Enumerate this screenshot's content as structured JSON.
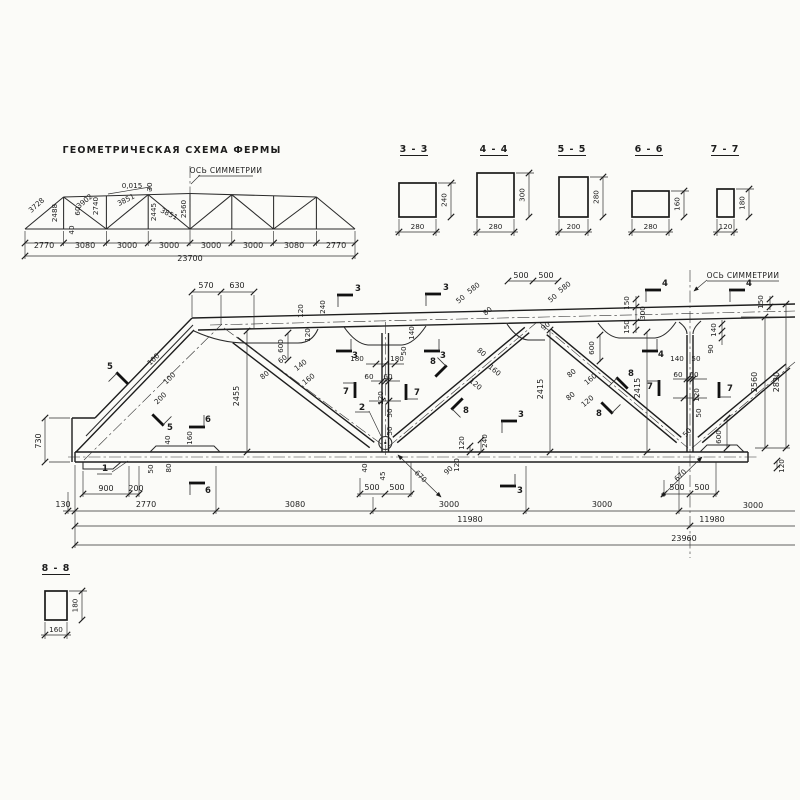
{
  "scheme": {
    "title": "ГЕОМЕТРИЧЕСКАЯ СХЕМА ФЕРМЫ",
    "axis_label": "ОСЬ СИММЕТРИИ",
    "labels": [
      {
        "t": "3728",
        "x": 38,
        "y": 207,
        "r": -42
      },
      {
        "t": "2488",
        "x": 57,
        "y": 213,
        "r": -90
      },
      {
        "t": "3902",
        "x": 86,
        "y": 203,
        "r": -40
      },
      {
        "t": "2740",
        "x": 98,
        "y": 206,
        "r": -90
      },
      {
        "t": "60",
        "x": 80,
        "y": 211,
        "r": -90
      },
      {
        "t": "40",
        "x": 74,
        "y": 230,
        "r": -90
      },
      {
        "t": "0,015",
        "x": 132,
        "y": 188
      },
      {
        "t": "30",
        "x": 152,
        "y": 187,
        "r": -90
      },
      {
        "t": "3851",
        "x": 127,
        "y": 202,
        "r": -27
      },
      {
        "t": "2445",
        "x": 156,
        "y": 212,
        "r": -90
      },
      {
        "t": "3851",
        "x": 168,
        "y": 216,
        "r": 27
      },
      {
        "t": "2560",
        "x": 186,
        "y": 209,
        "r": -90
      },
      {
        "t": "2770",
        "x": 44,
        "y": 248,
        "c": "b"
      },
      {
        "t": "3080",
        "x": 85,
        "y": 248,
        "c": "b"
      },
      {
        "t": "3000",
        "x": 127,
        "y": 248,
        "c": "b"
      },
      {
        "t": "3000",
        "x": 169,
        "y": 248,
        "c": "b"
      },
      {
        "t": "3000",
        "x": 211,
        "y": 248,
        "c": "b"
      },
      {
        "t": "3000",
        "x": 253,
        "y": 248,
        "c": "b"
      },
      {
        "t": "3080",
        "x": 294,
        "y": 248,
        "c": "b"
      },
      {
        "t": "2770",
        "x": 336,
        "y": 248,
        "c": "b"
      },
      {
        "t": "23700",
        "x": 190,
        "y": 261,
        "c": "b"
      }
    ]
  },
  "sections": {
    "items": [
      {
        "name": "3 - 3",
        "width": "280",
        "height": "240",
        "x": 399,
        "y": 183,
        "w": 37,
        "h": 34,
        "tx": 414
      },
      {
        "name": "4 - 4",
        "width": "280",
        "height": "300",
        "x": 477,
        "y": 173,
        "w": 37,
        "h": 44,
        "tx": 494
      },
      {
        "name": "5 - 5",
        "width": "200",
        "height": "280",
        "x": 559,
        "y": 177,
        "w": 29,
        "h": 40,
        "tx": 572
      },
      {
        "name": "6 - 6",
        "width": "280",
        "height": "160",
        "x": 632,
        "y": 191,
        "w": 37,
        "h": 26,
        "tx": 649
      },
      {
        "name": "7 - 7",
        "width": "120",
        "height": "180",
        "x": 717,
        "y": 189,
        "w": 17,
        "h": 28,
        "tx": 725
      },
      {
        "name": "8 - 8",
        "width": "160",
        "height": "180",
        "x": 45,
        "y": 591,
        "w": 22,
        "h": 29,
        "tx": 56,
        "ty": 571
      }
    ]
  },
  "main": {
    "axis_label": "ОСЬ СИММЕТРИИ",
    "node_labels": [
      {
        "t": "1",
        "x": 105,
        "y": 471
      },
      {
        "t": "2",
        "x": 362,
        "y": 410
      }
    ],
    "flags": [
      {
        "t": "5",
        "lx": 110,
        "ly": 369,
        "bx": 122,
        "by": 378,
        "br": 45
      },
      {
        "t": "5",
        "lx": 170,
        "ly": 430,
        "bx": 158,
        "by": 420,
        "br": 225
      },
      {
        "t": "6",
        "lx": 208,
        "ly": 422,
        "bx": 197,
        "by": 427,
        "br": 180
      },
      {
        "t": "6",
        "lx": 208,
        "ly": 493,
        "bx": 197,
        "by": 483,
        "br": 0
      },
      {
        "t": "3",
        "lx": 358,
        "ly": 291,
        "bx": 345,
        "by": 295,
        "br": 0
      },
      {
        "t": "3",
        "lx": 355,
        "ly": 358,
        "bx": 344,
        "by": 351,
        "br": 180
      },
      {
        "t": "3",
        "lx": 446,
        "ly": 290,
        "bx": 433,
        "by": 294,
        "br": 0
      },
      {
        "t": "3",
        "lx": 443,
        "ly": 358,
        "bx": 432,
        "by": 351,
        "br": 180
      },
      {
        "t": "3",
        "lx": 521,
        "ly": 417,
        "bx": 509,
        "by": 421,
        "br": 0
      },
      {
        "t": "3",
        "lx": 520,
        "ly": 493,
        "bx": 508,
        "by": 486,
        "br": 180
      },
      {
        "t": "4",
        "lx": 665,
        "ly": 286,
        "bx": 653,
        "by": 290,
        "br": 0
      },
      {
        "t": "4",
        "lx": 661,
        "ly": 357,
        "bx": 650,
        "by": 351,
        "br": 180
      },
      {
        "t": "4",
        "lx": 749,
        "ly": 286,
        "bx": 737,
        "by": 290,
        "br": 0
      },
      {
        "t": "7",
        "lx": 346,
        "ly": 394,
        "bx": 355,
        "by": 390,
        "br": 90
      },
      {
        "t": "7",
        "lx": 417,
        "ly": 395,
        "bx": 406,
        "by": 392,
        "br": 270
      },
      {
        "t": "7",
        "lx": 650,
        "ly": 389,
        "bx": 659,
        "by": 388,
        "br": 90
      },
      {
        "t": "7",
        "lx": 730,
        "ly": 391,
        "bx": 719,
        "by": 390,
        "br": 270
      },
      {
        "t": "8",
        "lx": 433,
        "ly": 364,
        "bx": 441,
        "by": 371,
        "br": 135
      },
      {
        "t": "8",
        "lx": 466,
        "ly": 413,
        "bx": 457,
        "by": 404,
        "br": 315
      },
      {
        "t": "8",
        "lx": 599,
        "ly": 416,
        "bx": 607,
        "by": 408,
        "br": 225
      },
      {
        "t": "8",
        "lx": 631,
        "ly": 376,
        "bx": 622,
        "by": 383,
        "br": 45
      }
    ],
    "labels": [
      {
        "t": "570",
        "x": 206,
        "y": 288,
        "c": "b"
      },
      {
        "t": "630",
        "x": 237,
        "y": 288,
        "c": "b"
      },
      {
        "t": "120",
        "x": 303,
        "y": 311,
        "r": -90
      },
      {
        "t": "240",
        "x": 325,
        "y": 307,
        "r": -90
      },
      {
        "t": "120",
        "x": 310,
        "y": 335,
        "r": -90
      },
      {
        "t": "600",
        "x": 283,
        "y": 346,
        "r": -90
      },
      {
        "t": "100",
        "x": 155,
        "y": 361,
        "r": -44
      },
      {
        "t": "100",
        "x": 171,
        "y": 380,
        "r": -44
      },
      {
        "t": "200",
        "x": 162,
        "y": 400,
        "r": -44
      },
      {
        "t": "80",
        "x": 266,
        "y": 377,
        "r": -38
      },
      {
        "t": "60",
        "x": 284,
        "y": 361,
        "r": -38
      },
      {
        "t": "140",
        "x": 302,
        "y": 367,
        "r": -38
      },
      {
        "t": "160",
        "x": 310,
        "y": 381,
        "r": -38
      },
      {
        "t": "2455",
        "x": 239,
        "y": 396,
        "r": -90,
        "c": "b"
      },
      {
        "t": "180",
        "x": 357,
        "y": 361
      },
      {
        "t": "180",
        "x": 397,
        "y": 361
      },
      {
        "t": "140",
        "x": 414,
        "y": 333,
        "r": -90
      },
      {
        "t": "50",
        "x": 406,
        "y": 351,
        "r": -90
      },
      {
        "t": "60",
        "x": 369,
        "y": 379
      },
      {
        "t": "60",
        "x": 388,
        "y": 379
      },
      {
        "t": "120",
        "x": 383,
        "y": 398,
        "r": -90
      },
      {
        "t": "580",
        "x": 475,
        "y": 290,
        "r": -38
      },
      {
        "t": "50",
        "x": 462,
        "y": 301,
        "r": -38
      },
      {
        "t": "80",
        "x": 489,
        "y": 313,
        "r": -38
      },
      {
        "t": "500",
        "x": 521,
        "y": 278,
        "c": "b"
      },
      {
        "t": "500",
        "x": 546,
        "y": 278,
        "c": "b"
      },
      {
        "t": "580",
        "x": 566,
        "y": 289,
        "r": -38
      },
      {
        "t": "50",
        "x": 554,
        "y": 300,
        "r": -38
      },
      {
        "t": "90",
        "x": 547,
        "y": 328,
        "r": -38
      },
      {
        "t": "80",
        "x": 480,
        "y": 354,
        "r": 40
      },
      {
        "t": "160",
        "x": 493,
        "y": 372,
        "r": 40
      },
      {
        "t": "120",
        "x": 474,
        "y": 386,
        "r": 40
      },
      {
        "t": "600",
        "x": 594,
        "y": 348,
        "r": -90
      },
      {
        "t": "80",
        "x": 573,
        "y": 375,
        "r": -40
      },
      {
        "t": "160",
        "x": 592,
        "y": 381,
        "r": -40
      },
      {
        "t": "80",
        "x": 572,
        "y": 398,
        "r": -40
      },
      {
        "t": "120",
        "x": 589,
        "y": 403,
        "r": -40
      },
      {
        "t": "2415",
        "x": 543,
        "y": 389,
        "r": -90,
        "c": "b"
      },
      {
        "t": "2415",
        "x": 640,
        "y": 388,
        "r": -90,
        "c": "b"
      },
      {
        "t": "150",
        "x": 629,
        "y": 303,
        "r": -90
      },
      {
        "t": "300",
        "x": 645,
        "y": 313,
        "r": -90
      },
      {
        "t": "150",
        "x": 629,
        "y": 327,
        "r": -90
      },
      {
        "t": "150",
        "x": 763,
        "y": 302,
        "r": -90
      },
      {
        "t": "140",
        "x": 716,
        "y": 330,
        "r": -90
      },
      {
        "t": "90",
        "x": 713,
        "y": 349,
        "r": -90
      },
      {
        "t": "140",
        "x": 677,
        "y": 361
      },
      {
        "t": "50",
        "x": 696,
        "y": 361
      },
      {
        "t": "60",
        "x": 678,
        "y": 377
      },
      {
        "t": "60",
        "x": 694,
        "y": 377
      },
      {
        "t": "120",
        "x": 699,
        "y": 395,
        "r": -90
      },
      {
        "t": "50",
        "x": 701,
        "y": 413,
        "r": -90
      },
      {
        "t": "50",
        "x": 689,
        "y": 434,
        "r": -50
      },
      {
        "t": "600",
        "x": 721,
        "y": 437,
        "r": -90
      },
      {
        "t": "2560",
        "x": 757,
        "y": 382,
        "r": -90,
        "c": "b"
      },
      {
        "t": "2830",
        "x": 779,
        "y": 382,
        "r": -90,
        "c": "b"
      },
      {
        "t": "120",
        "x": 784,
        "y": 466,
        "r": -90
      },
      {
        "t": "730",
        "x": 41,
        "y": 441,
        "r": -90,
        "c": "b"
      },
      {
        "t": "40",
        "x": 170,
        "y": 440,
        "r": -90
      },
      {
        "t": "160",
        "x": 192,
        "y": 438,
        "r": -90
      },
      {
        "t": "50",
        "x": 153,
        "y": 469,
        "r": -90
      },
      {
        "t": "80",
        "x": 171,
        "y": 468,
        "r": -90
      },
      {
        "t": "50",
        "x": 392,
        "y": 413,
        "r": -90
      },
      {
        "t": "50",
        "x": 392,
        "y": 431,
        "r": -90
      },
      {
        "t": "40",
        "x": 367,
        "y": 468,
        "r": -90
      },
      {
        "t": "45",
        "x": 385,
        "y": 476,
        "r": -90
      },
      {
        "t": "90",
        "x": 450,
        "y": 472,
        "r": -44
      },
      {
        "t": "670",
        "x": 419,
        "y": 478,
        "r": 44
      },
      {
        "t": "120",
        "x": 464,
        "y": 443,
        "r": -90
      },
      {
        "t": "240",
        "x": 487,
        "y": 441,
        "r": -90
      },
      {
        "t": "120",
        "x": 459,
        "y": 465,
        "r": -90
      },
      {
        "t": "670",
        "x": 682,
        "y": 477,
        "r": -44
      },
      {
        "t": "500",
        "x": 372,
        "y": 490,
        "c": "b"
      },
      {
        "t": "500",
        "x": 397,
        "y": 490,
        "c": "b"
      },
      {
        "t": "500",
        "x": 677,
        "y": 490,
        "c": "b"
      },
      {
        "t": "500",
        "x": 702,
        "y": 490,
        "c": "b"
      },
      {
        "t": "900",
        "x": 106,
        "y": 491,
        "c": "b"
      },
      {
        "t": "200",
        "x": 136,
        "y": 491,
        "c": "b"
      },
      {
        "t": "130",
        "x": 63,
        "y": 507,
        "c": "b"
      },
      {
        "t": "2770",
        "x": 146,
        "y": 507,
        "c": "b"
      },
      {
        "t": "3080",
        "x": 295,
        "y": 507,
        "c": "b"
      },
      {
        "t": "3000",
        "x": 449,
        "y": 507,
        "c": "b"
      },
      {
        "t": "3000",
        "x": 602,
        "y": 507,
        "c": "b"
      },
      {
        "t": "3000",
        "x": 753,
        "y": 508,
        "c": "b"
      },
      {
        "t": "11980",
        "x": 470,
        "y": 522,
        "c": "b"
      },
      {
        "t": "11980",
        "x": 712,
        "y": 522,
        "c": "b"
      },
      {
        "t": "23960",
        "x": 684,
        "y": 541,
        "c": "b"
      }
    ]
  },
  "colors": {
    "ink": "#1d1d1d",
    "paper": "#fbfbf8"
  }
}
